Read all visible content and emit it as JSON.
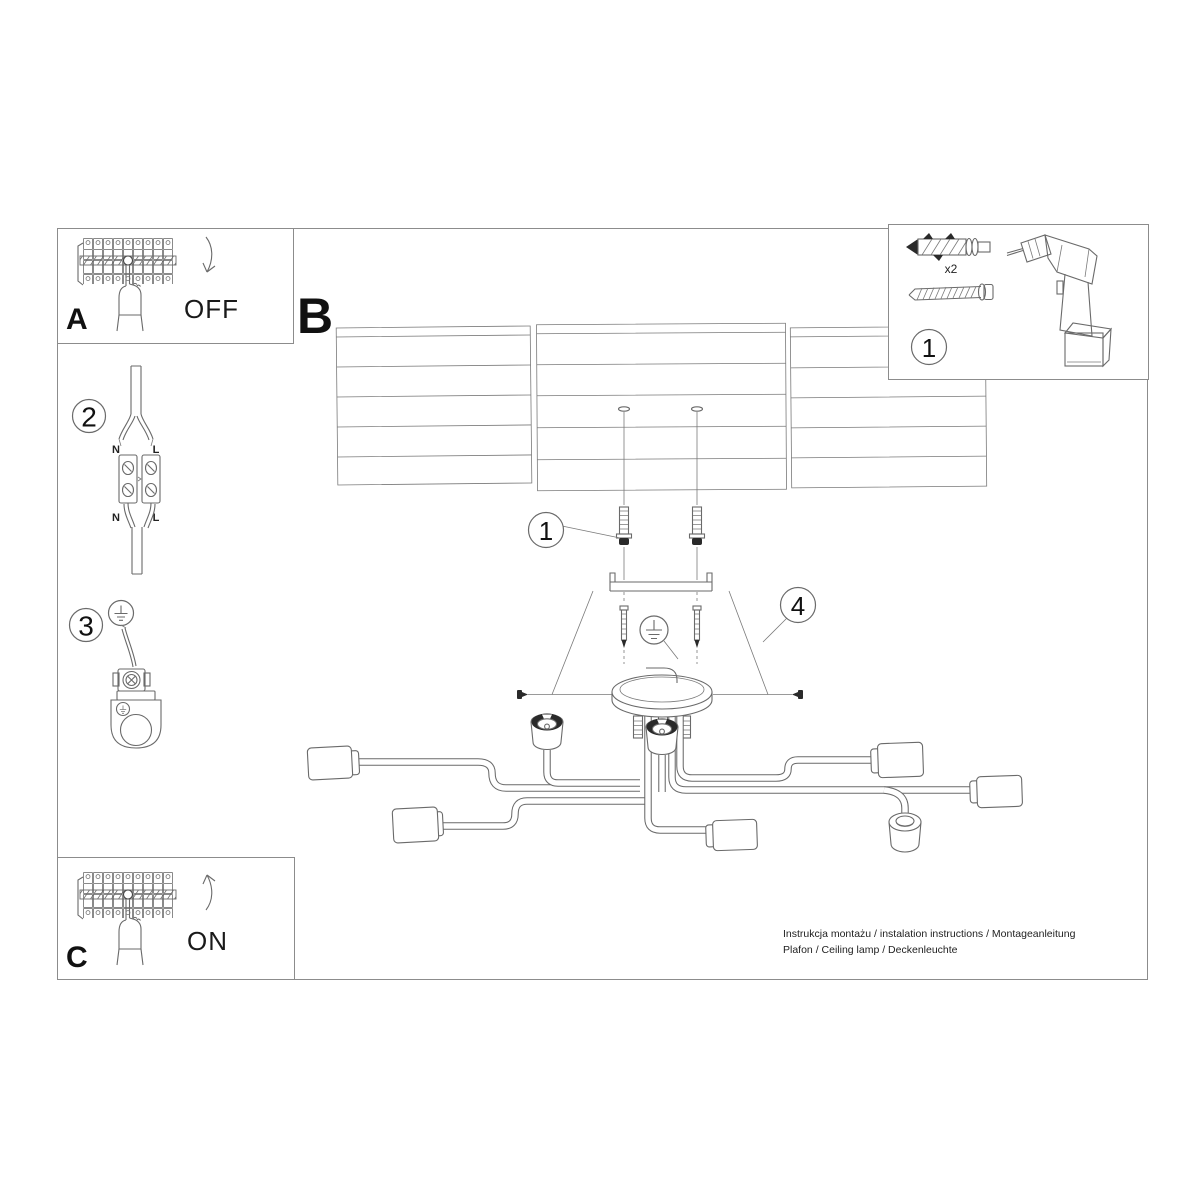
{
  "colors": {
    "background": "#ffffff",
    "frame": "#8c8c8c",
    "line": "#6a6a6a",
    "text": "#111111",
    "shade": "#000000"
  },
  "panel_a": {
    "letter": "A",
    "state_label": "OFF"
  },
  "panel_c": {
    "letter": "C",
    "state_label": "ON"
  },
  "section_b": {
    "letter": "B"
  },
  "step_2": {
    "number": "2",
    "labels": {
      "top_left": "N",
      "top_right": "L",
      "bottom_left": "N",
      "bottom_right": "L"
    }
  },
  "step_3": {
    "number": "3"
  },
  "parts_box": {
    "number": "1",
    "dowel_quantity": "x2"
  },
  "callouts": {
    "dowels": "1",
    "canopy": "4"
  },
  "footer": {
    "line_1": "Instrukcja montażu / instalation instructions / Montageanleitung",
    "line_2": "Plafon / Ceiling lamp / Deckenleuchte"
  }
}
